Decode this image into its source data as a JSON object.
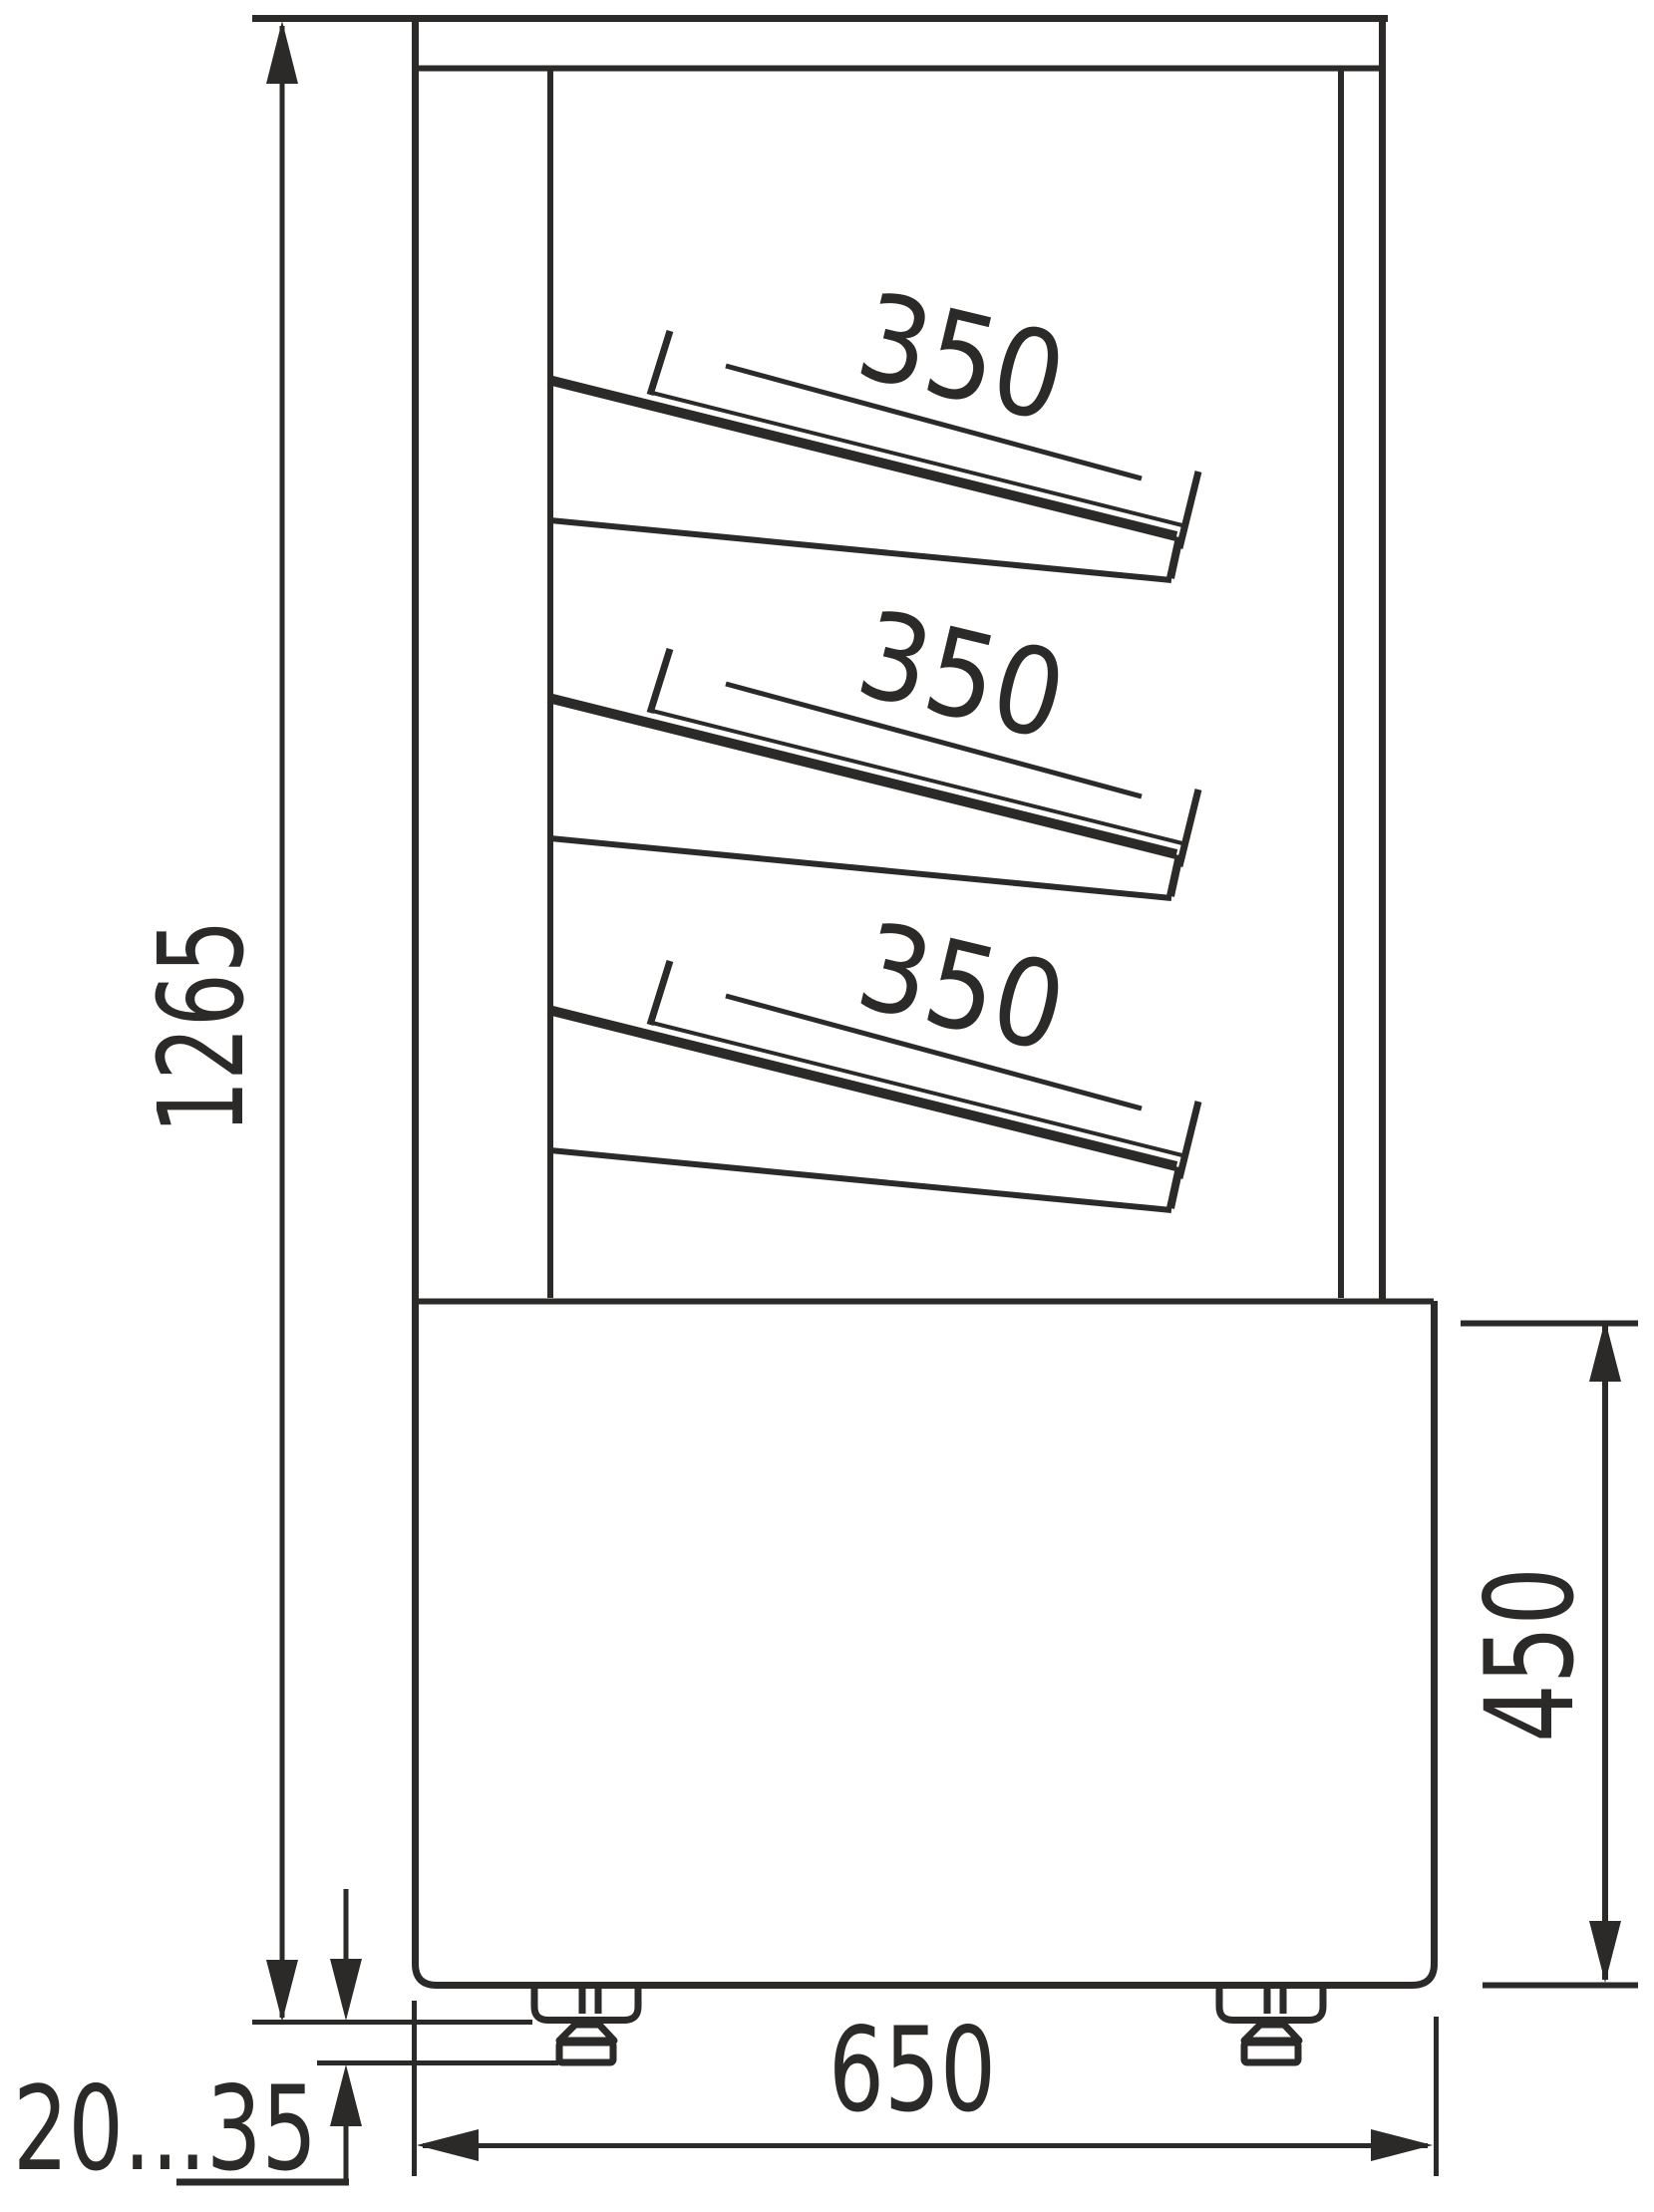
{
  "drawing": {
    "colors": {
      "line": "#2b2a29",
      "background": "#ffffff"
    },
    "dimensions": {
      "overall_height": "1265",
      "shelf_depths": [
        "350",
        "350",
        "350"
      ],
      "base_height": "450",
      "base_depth": "650",
      "foot_adjustment_range": "20...35"
    }
  }
}
